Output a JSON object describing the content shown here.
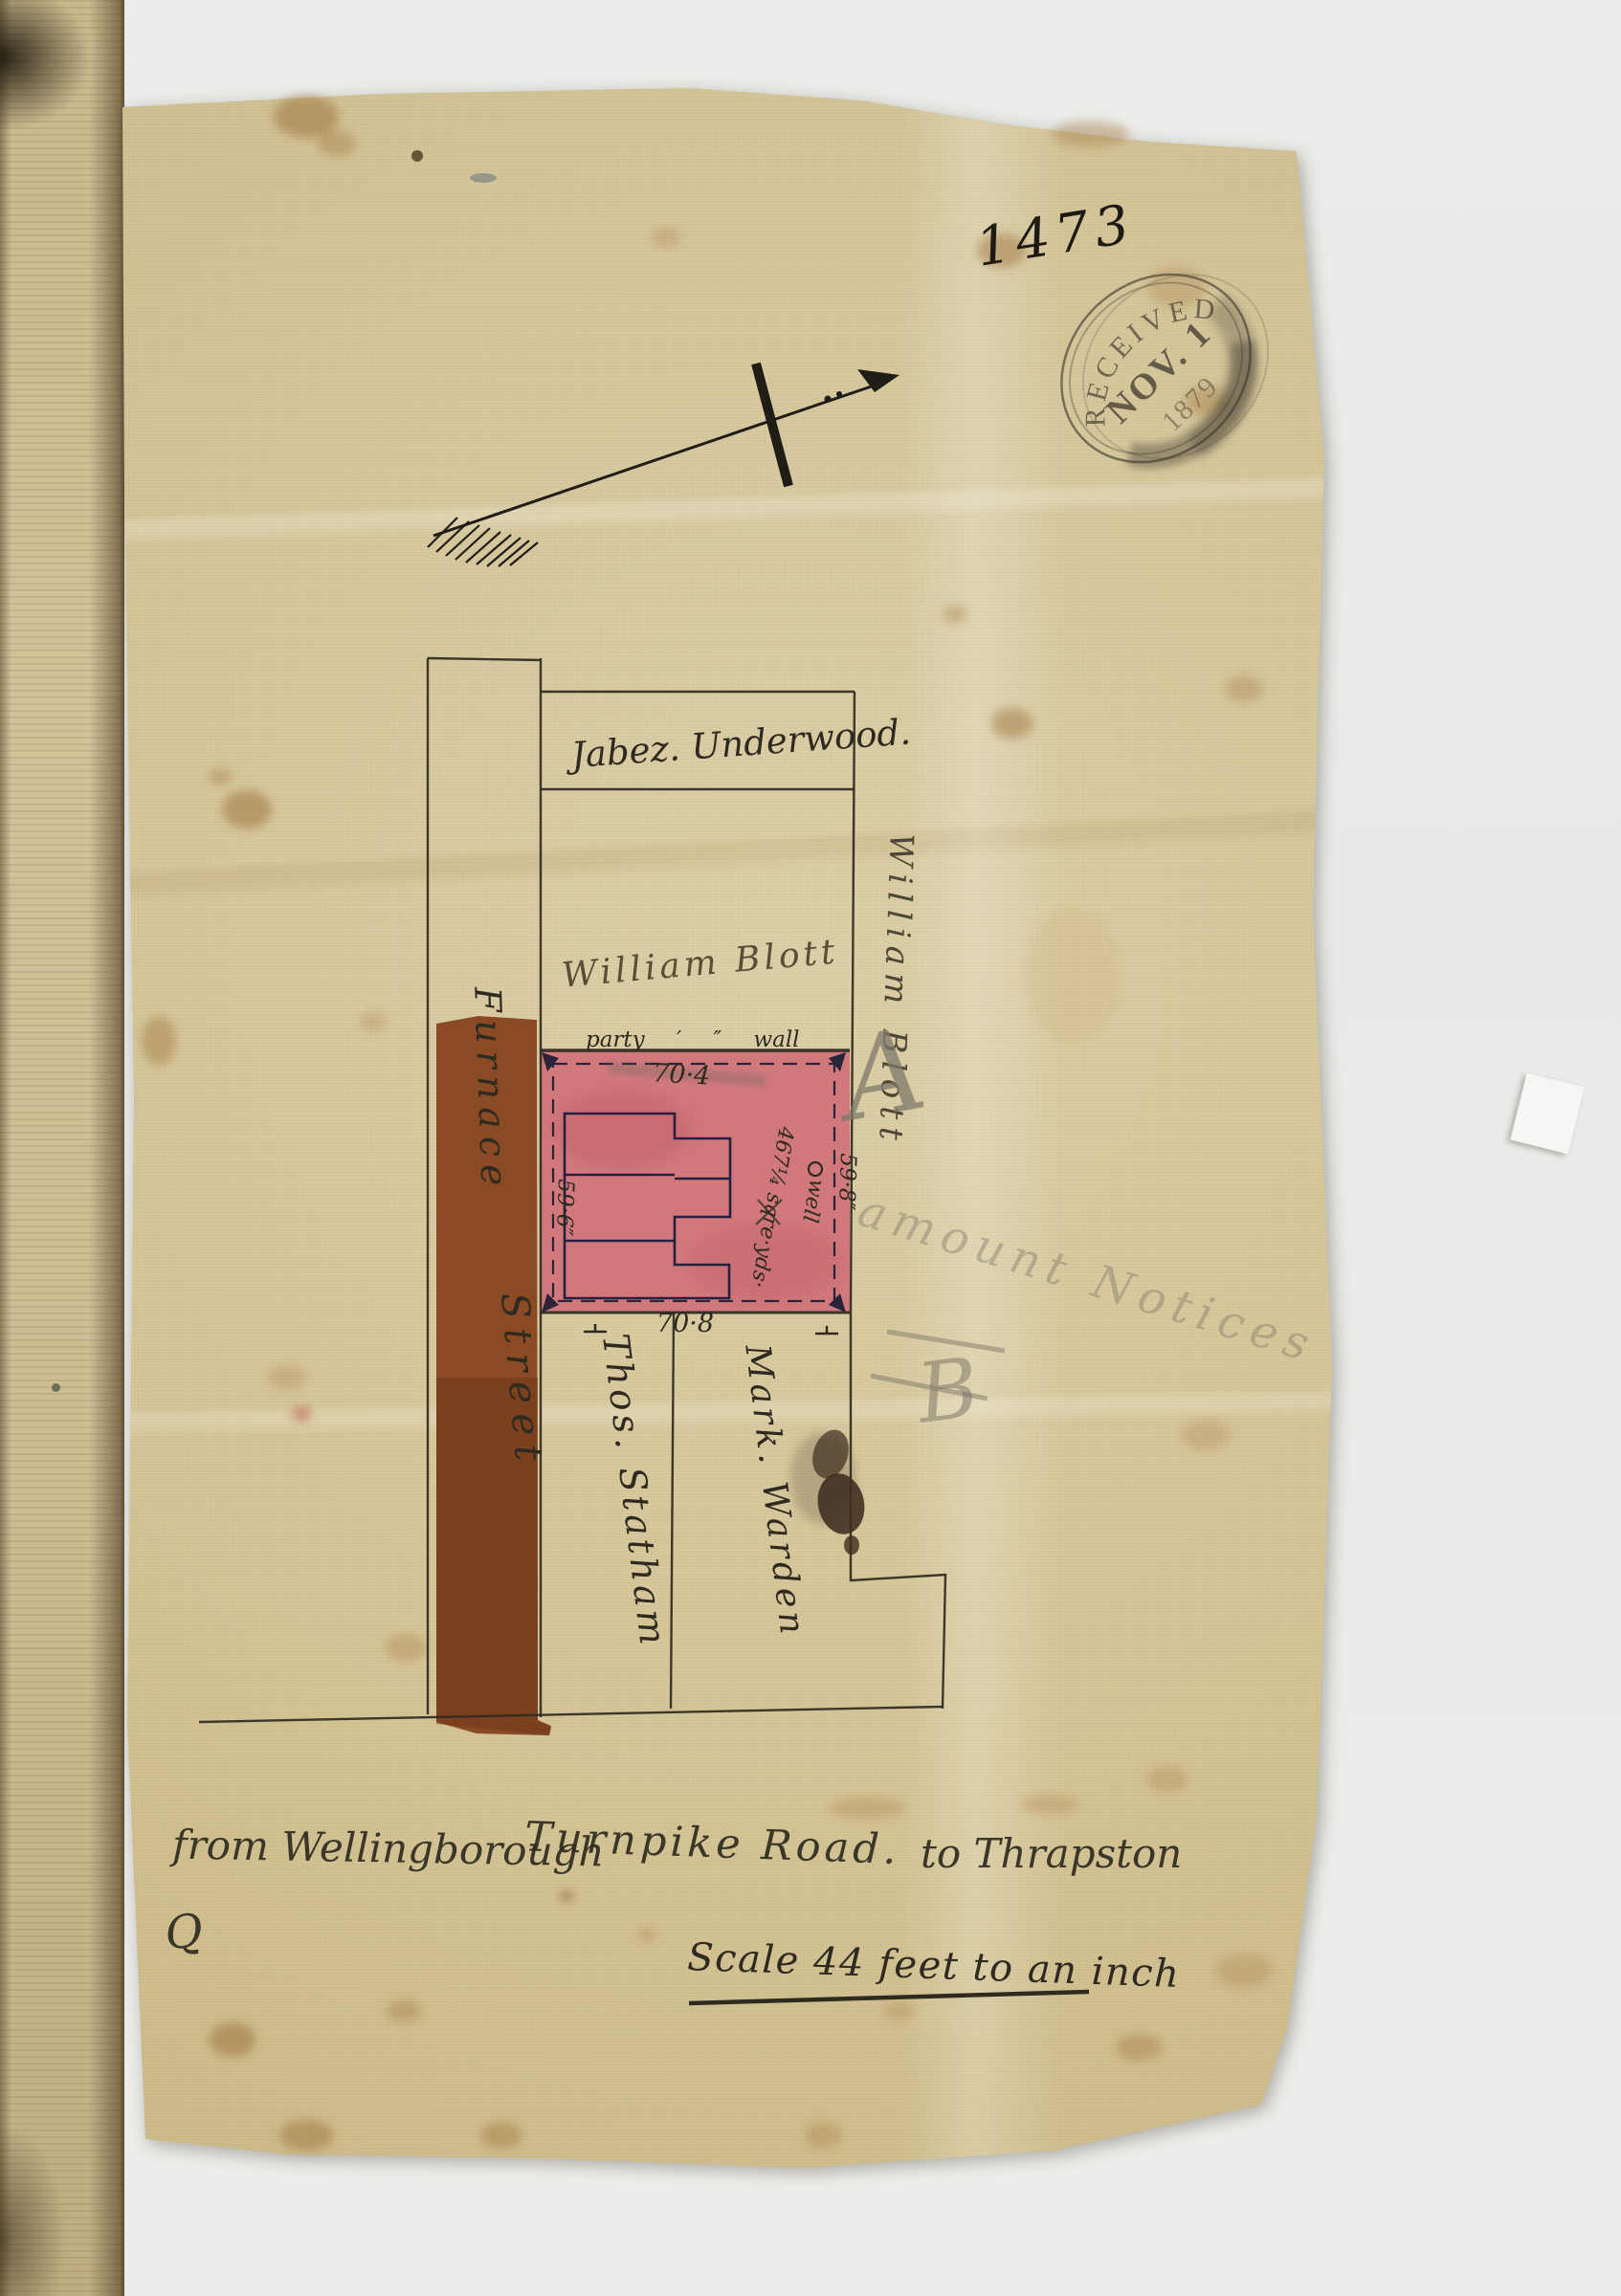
{
  "plan_number": "1473",
  "stamp": {
    "top_arc": "RECEIVED",
    "date_line": "NOV. 1",
    "year_line": "1879"
  },
  "labels": {
    "plot_top_owner": "Jabez. Underwood.",
    "plot_mid_owner": "William Blott",
    "boundary_owner_vertical": "William Blott",
    "street_line1": "Furnace",
    "street_line2": "Street",
    "party_wall": "party ′ ″ wall",
    "plot_bottom_left_owner": "Thos. Statham",
    "plot_bottom_right_owner": "Mark. Warden",
    "area": "467¼ sqre·yds·",
    "well": "well"
  },
  "dims": {
    "top": "70·4",
    "bottom": "70·8",
    "left": "59·6″",
    "right": "59·8″"
  },
  "pencil": {
    "mark_a": "A",
    "mark_b": "B",
    "note": "amount Notices",
    "mark_q": "Q"
  },
  "caption": {
    "from": "from Wellingborough",
    "road": "Turnpike Road.",
    "to": "to Thrapston"
  },
  "scale_note": "Scale 44 feet to an inch",
  "icons": {
    "north_arrow": "north-arrow-icon",
    "well": "well-circle-icon",
    "received_stamp": "received-date-stamp"
  },
  "colors": {
    "plot_pink": "#cf6a76",
    "plot_pink_dark": "#b8505e",
    "street_brown": "#8a4a24",
    "street_brown_dark": "#6f3a1c",
    "ink": "#2e2a20",
    "building_ink": "#262040",
    "pencil": "#7d786a",
    "stamp_ink": "#564f3e",
    "paper": "#d9cda6"
  }
}
